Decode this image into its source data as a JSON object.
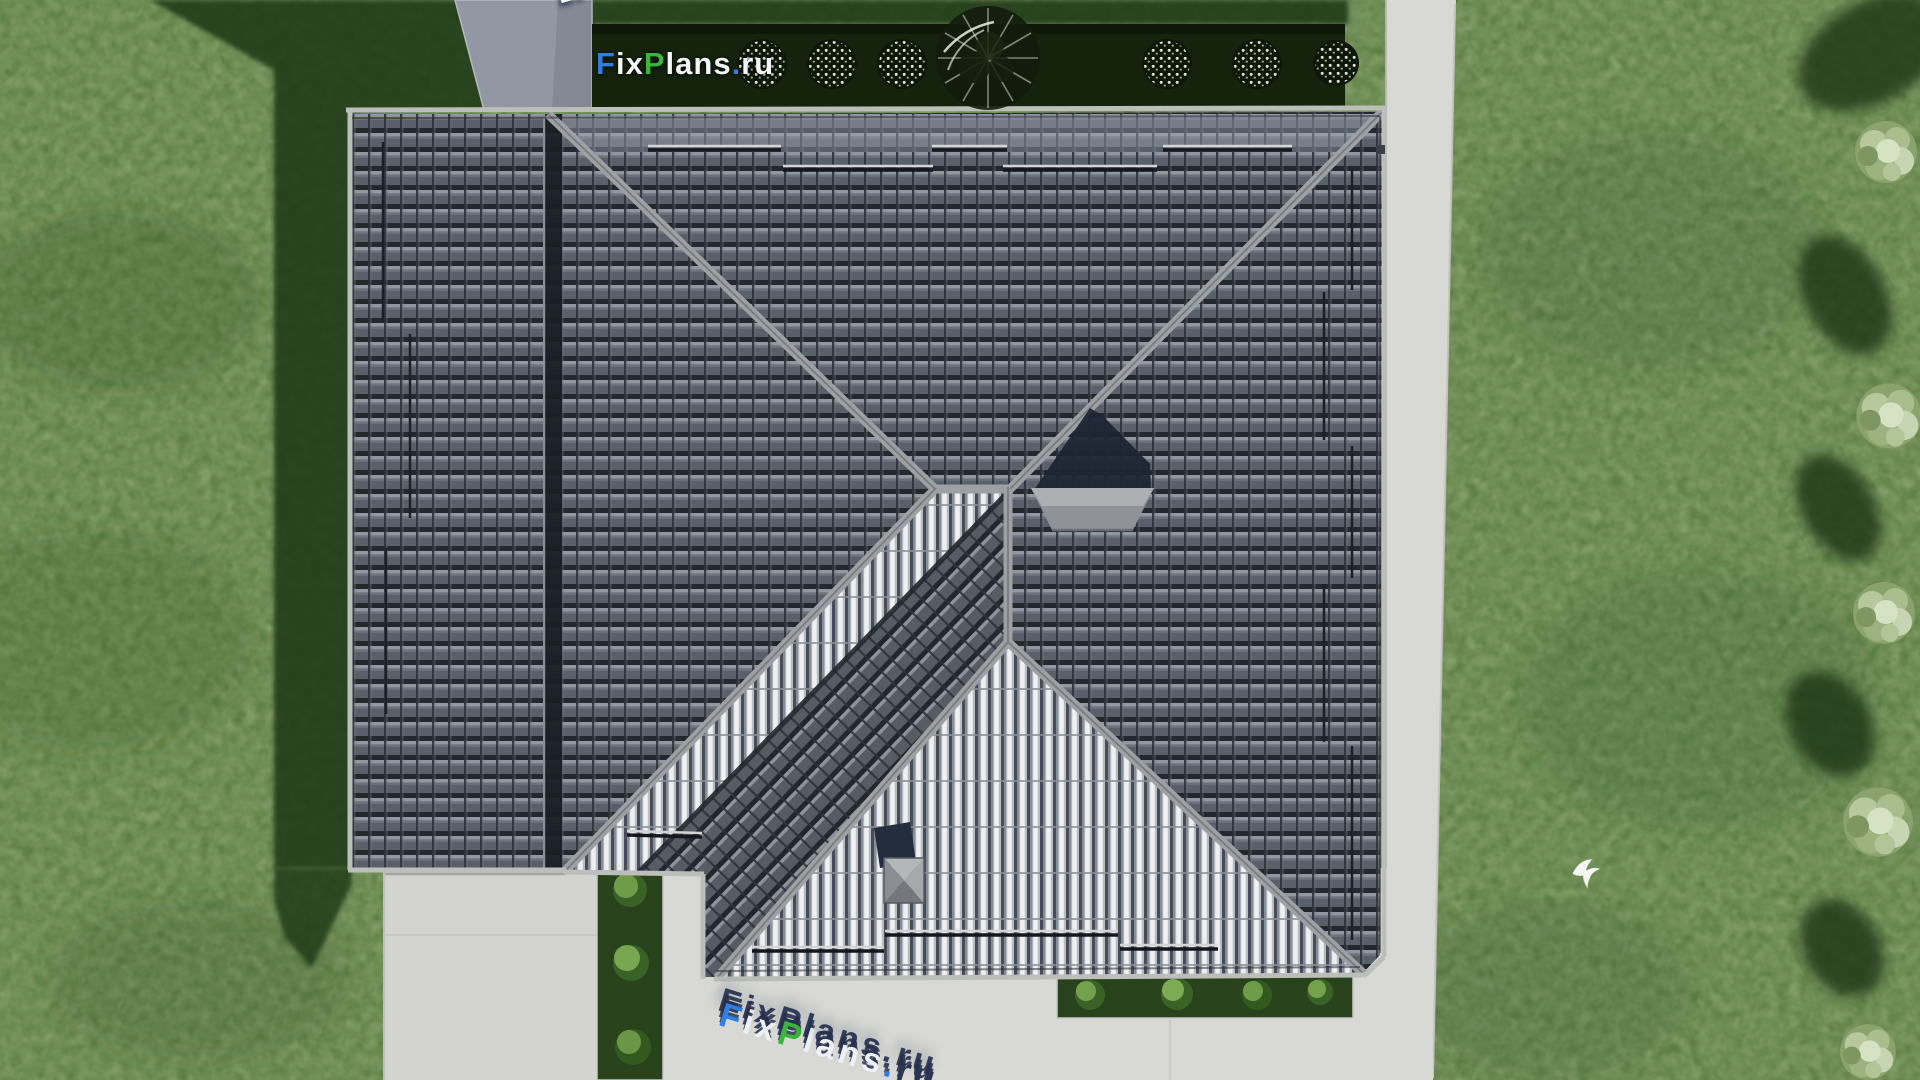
{
  "scene": {
    "title": "Aerial top-down 3D render of a single-family house hip roof with lawn, paths and hedges",
    "brand": "FixPlans.ru"
  },
  "watermarks": {
    "main": {
      "text": "FixPlans.ru",
      "letters": [
        {
          "ch": "F",
          "color": "#2e7fe0"
        },
        {
          "ch": "i",
          "color": "#f4f6f8"
        },
        {
          "ch": "x",
          "color": "#f4f6f8"
        },
        {
          "ch": "P",
          "color": "#3cb53c"
        },
        {
          "ch": "l",
          "color": "#f4f6f8"
        },
        {
          "ch": "a",
          "color": "#f4f6f8"
        },
        {
          "ch": "n",
          "color": "#f4f6f8"
        },
        {
          "ch": "s",
          "color": "#f4f6f8"
        },
        {
          "ch": ".",
          "color": "#2e7fe0"
        },
        {
          "ch": "r",
          "color": "#f4f6f8"
        },
        {
          "ch": "u",
          "color": "#f4f6f8"
        }
      ]
    },
    "top_tilted": {
      "text": "FixPlans.ru",
      "rotation_deg": -17,
      "letters": [
        {
          "ch": "F",
          "color": "#2e7fe0"
        },
        {
          "ch": "i",
          "color": "#8f9aab"
        },
        {
          "ch": "x",
          "color": "#8f9aab"
        },
        {
          "ch": "P",
          "color": "#3cb53c"
        },
        {
          "ch": "l",
          "color": "#8f9aab"
        },
        {
          "ch": "a",
          "color": "#8f9aab"
        },
        {
          "ch": "n",
          "color": "#8f9aab"
        },
        {
          "ch": "s",
          "color": "#8f9aab"
        },
        {
          "ch": ".",
          "color": "#2e7fe0"
        },
        {
          "ch": "r",
          "color": "#c6cede",
          "dark": true
        },
        {
          "ch": "u",
          "color": "#c6cede",
          "dark": true
        }
      ]
    },
    "bottom_tilted": {
      "text": "FixPlans.ru",
      "rotation_deg": 17,
      "letters": [
        {
          "ch": "F",
          "color": "#2f80e2"
        },
        {
          "ch": "i",
          "color": "#eef1f5"
        },
        {
          "ch": "x",
          "color": "#eef1f5"
        },
        {
          "ch": "P",
          "color": "#3cb53c"
        },
        {
          "ch": "l",
          "color": "#eef1f5"
        },
        {
          "ch": "a",
          "color": "#eef1f5"
        },
        {
          "ch": "n",
          "color": "#eef1f5"
        },
        {
          "ch": "s",
          "color": "#eef1f5"
        },
        {
          "ch": ".",
          "color": "#2f80e2"
        },
        {
          "ch": "r",
          "color": "#2b3552"
        },
        {
          "ch": "u",
          "color": "#2b3552"
        }
      ]
    }
  },
  "palette": {
    "lawn": "#5c7a3f",
    "lawn_shadow": "#1f3913",
    "hedge_dark": "#15230d",
    "roof_tile_dark": "#596069",
    "roof_tile_bright": "#b7bcc3",
    "ridge_cap": "#9ea1a4",
    "valley_dark": "#1a1e25",
    "pavement": "#d8d9d5",
    "driveway": "#d3d4d0",
    "concrete_pad": "#9298a3",
    "chimney_shadow_navy": "#1d2433",
    "logo_blue": "#2e7fe0",
    "logo_green": "#3cb53c"
  },
  "inventory": {
    "building": "hip roof with dark interlocking tiles, two bright side slopes, south wing",
    "chimney_count": 2,
    "roof_snow_guard_rows": 13,
    "top_hedge_bush_count": 6,
    "side_hedge_bush_count": 3,
    "bottom_hedge_bush_count": 4,
    "right_tree_count": 5,
    "dark_top_tree_count": 1,
    "bird_count": 1
  }
}
